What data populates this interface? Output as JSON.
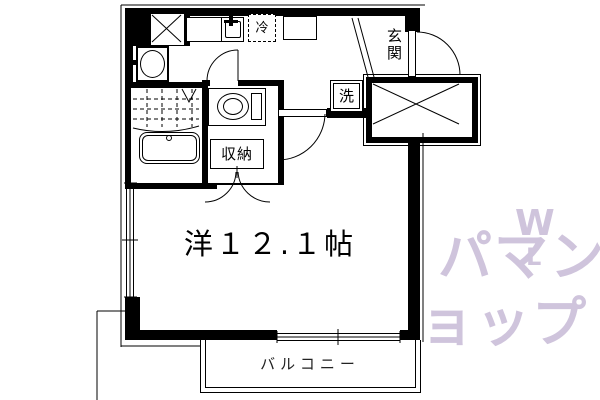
{
  "floorplan": {
    "labels": {
      "main_room": "洋１２.１帖",
      "balcony": "バルコニー",
      "entrance": "玄関",
      "storage": "収納",
      "washing_machine": "洗",
      "refrigerator": "冷"
    },
    "watermark": {
      "line1": "パマン",
      "line2": "ョップ",
      "mark": "W",
      "mark2": "L",
      "color": "#cfc4dc"
    },
    "colors": {
      "line": "#000000",
      "background": "#ffffff"
    }
  }
}
